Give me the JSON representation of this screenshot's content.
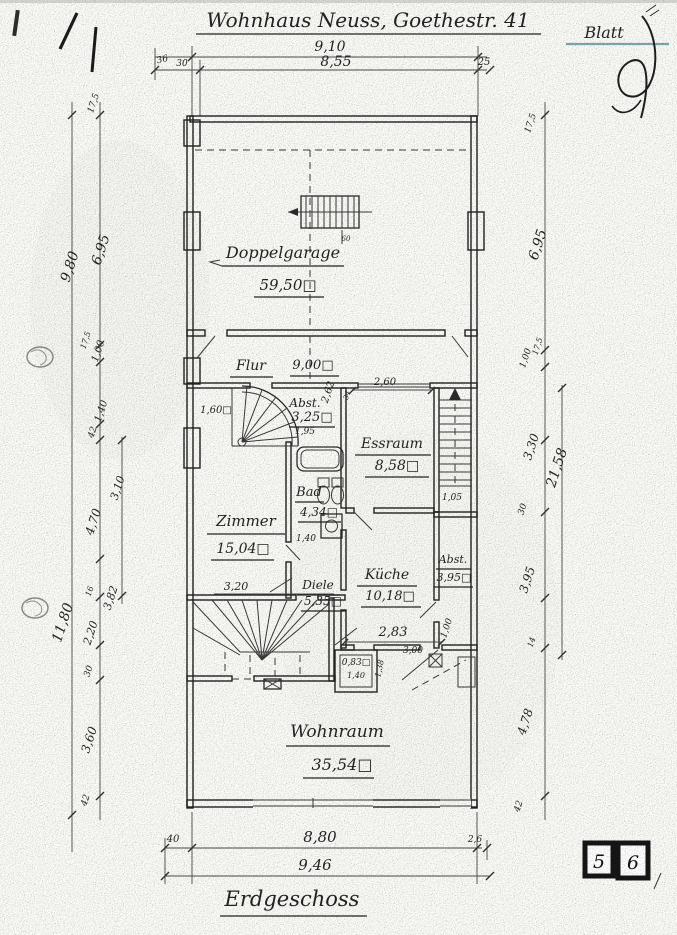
{
  "header": {
    "title": "Wohnhaus Neuss, Goethestr. 41",
    "sheet_label": "Blatt"
  },
  "footer": {
    "floor_label": "Erdgeschoss",
    "stamp": [
      "5",
      "6"
    ]
  },
  "rooms": {
    "garage": {
      "name": "Doppelgarage",
      "area": "59,50□"
    },
    "flur": {
      "name": "Flur",
      "area": "9,00□"
    },
    "abst1": {
      "name": "Abst.",
      "area": "3,25□"
    },
    "essraum": {
      "name": "Essraum",
      "area": "8,58□"
    },
    "bad": {
      "name": "Bad",
      "area": "4,34□"
    },
    "zimmer": {
      "name": "Zimmer",
      "area": "15,04□"
    },
    "kueche": {
      "name": "Küche",
      "area": "10,18□"
    },
    "diele": {
      "name": "Diele",
      "area": "5,35□"
    },
    "abst2": {
      "name": "Abst.",
      "area": "3,95□"
    },
    "wc": {
      "area": "0,83□"
    },
    "wohnraum": {
      "name": "Wohnraum",
      "area": "35,54□"
    }
  },
  "dims": {
    "top": [
      "9,10",
      "8,55",
      "36",
      "30",
      "25"
    ],
    "bottom": [
      "8,80",
      "9,46",
      "40",
      "2,6"
    ],
    "left": [
      "17,5",
      "9,80",
      "6,95",
      "1,00",
      "17,5",
      "1,40",
      "42",
      "3,10",
      "4,70",
      "16",
      "3,82",
      "11,80",
      "2,20",
      "30",
      "3,60",
      "42"
    ],
    "right": [
      "17,5",
      "6,95",
      "1,00",
      "17,5",
      "3,30",
      "21,58",
      "30",
      "3,95",
      "14",
      "4,78",
      "42"
    ],
    "interior": [
      "1,60□",
      "1,95",
      "2,62",
      "2,60",
      "34",
      "1,05",
      "1,40",
      "3,20",
      "2,83",
      "1,00",
      "1,40",
      "1,38",
      "3,00",
      "60"
    ]
  },
  "colors": {
    "ink": "#2b2b2b",
    "paper": "#fbfbf8",
    "blatt_underline": "#7fa9b0"
  }
}
